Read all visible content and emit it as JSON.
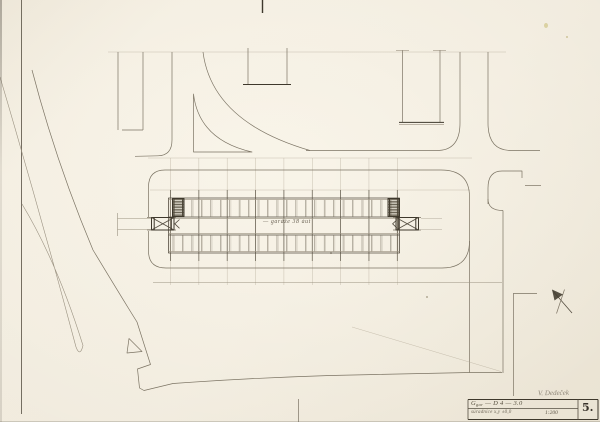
{
  "labels": {
    "building_label": "— garáže 38 áut",
    "signature": "V. Dedeček",
    "sheet_number": "5."
  },
  "title_block": {
    "code_main": "G",
    "code_sub": "gar",
    "code_rest": " — D 4 — 3.0",
    "row2_left": "súradnice x,y ±0,0",
    "scale": "1:200"
  },
  "colors": {
    "paper": "#f1ebdf",
    "pencil_light": "#9a9180",
    "pencil_dark": "#554e41",
    "ink": "#3e382c"
  },
  "drawing": {
    "stalls": {
      "rows": [
        {
          "y1": 199.8,
          "y2": 216.6
        },
        {
          "y1": 235.2,
          "y2": 251.6
        }
      ],
      "start_x": 173.0,
      "step": 9.45,
      "count": 24
    },
    "grid": {
      "start_x": 170.5,
      "step": 28.35,
      "count": 9,
      "y_faint": [
        158,
        285
      ],
      "y_dark": [
        190,
        261
      ]
    },
    "hatch_blocks": [
      {
        "x": 172.5,
        "y": 198.5,
        "w": 11.5,
        "h": 18
      },
      {
        "x": 388.0,
        "y": 198.5,
        "w": 11.5,
        "h": 18
      }
    ]
  }
}
